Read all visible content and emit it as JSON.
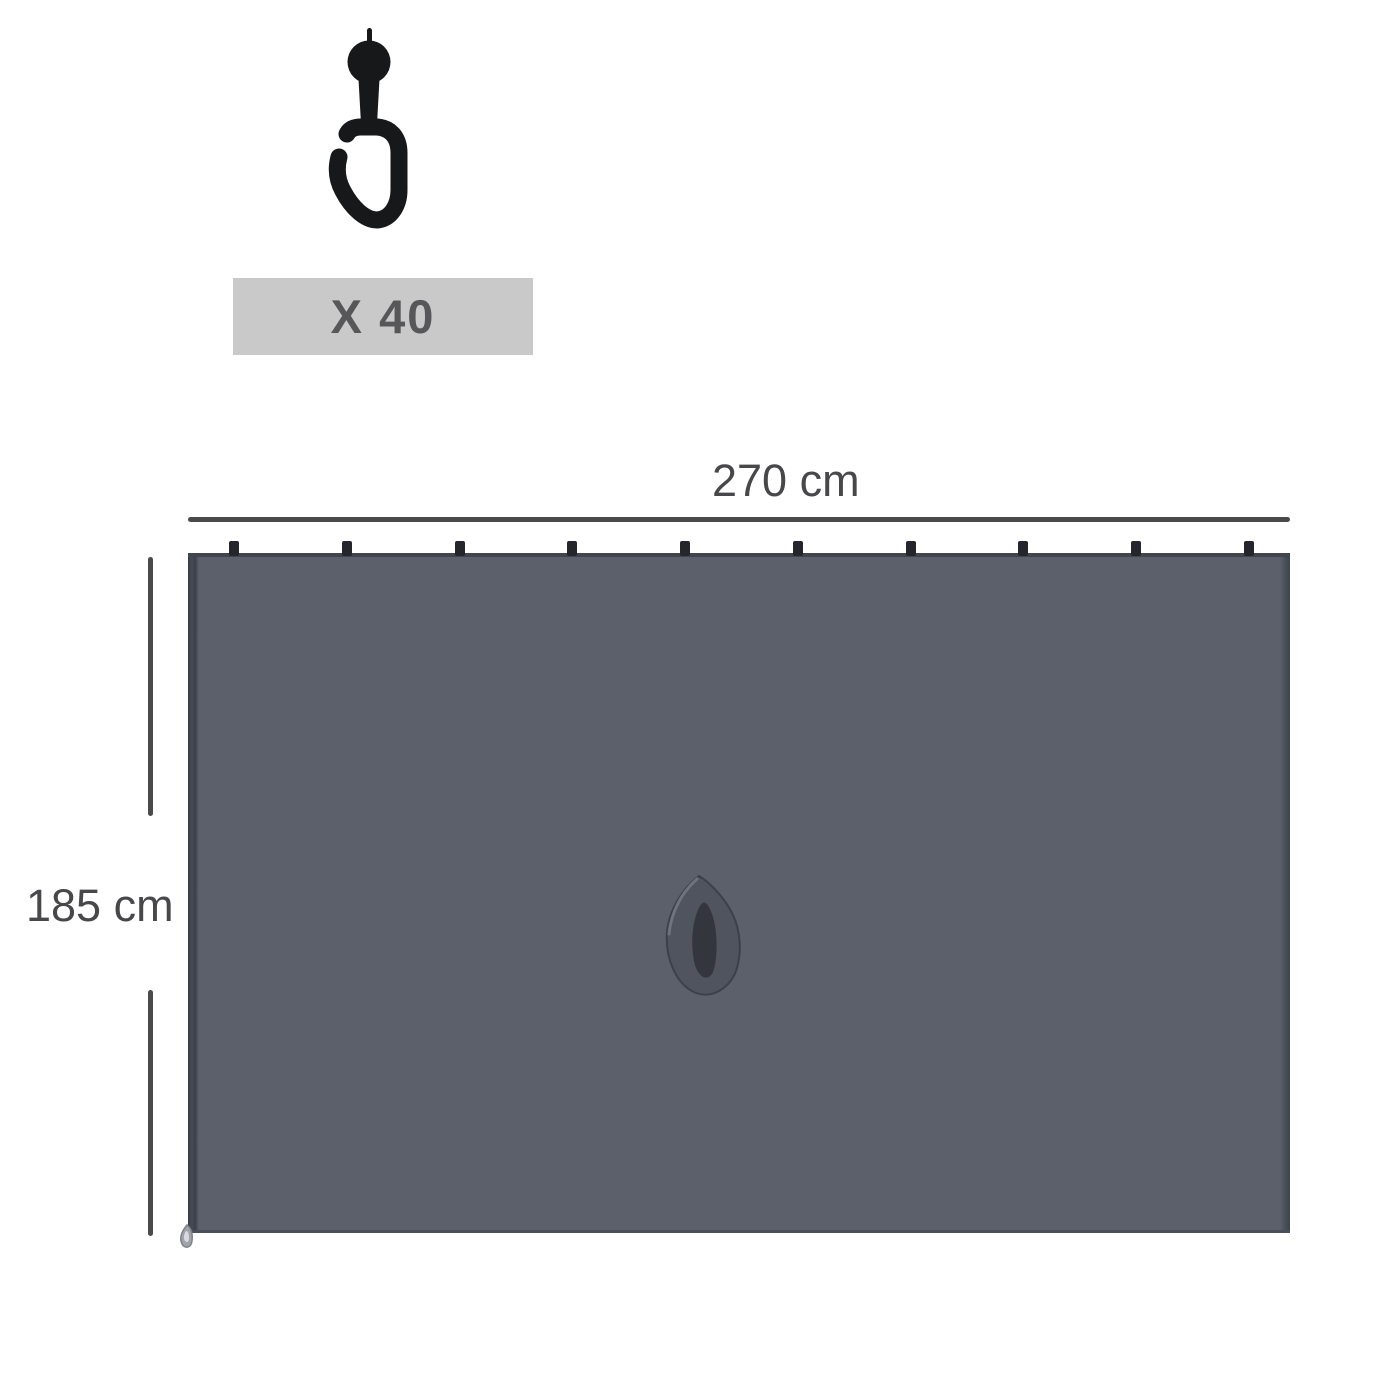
{
  "hook_kit": {
    "icon": "curtain-hook-icon",
    "quantity_label": "X 40",
    "icon_color": "#17181a",
    "badge_bg": "#c9c9c9",
    "badge_text_color": "#57575a"
  },
  "diagram": {
    "width_label": "270 cm",
    "height_label": "185 cm",
    "top_hook_count": 10,
    "panel_color": "#5c606b",
    "panel_edge_color": "#3d414b",
    "dimension_line_color": "#4a4a4a",
    "small_hook_color": "#24262b",
    "handle_color": "#50545e",
    "handle_slot_color": "#33363d"
  }
}
